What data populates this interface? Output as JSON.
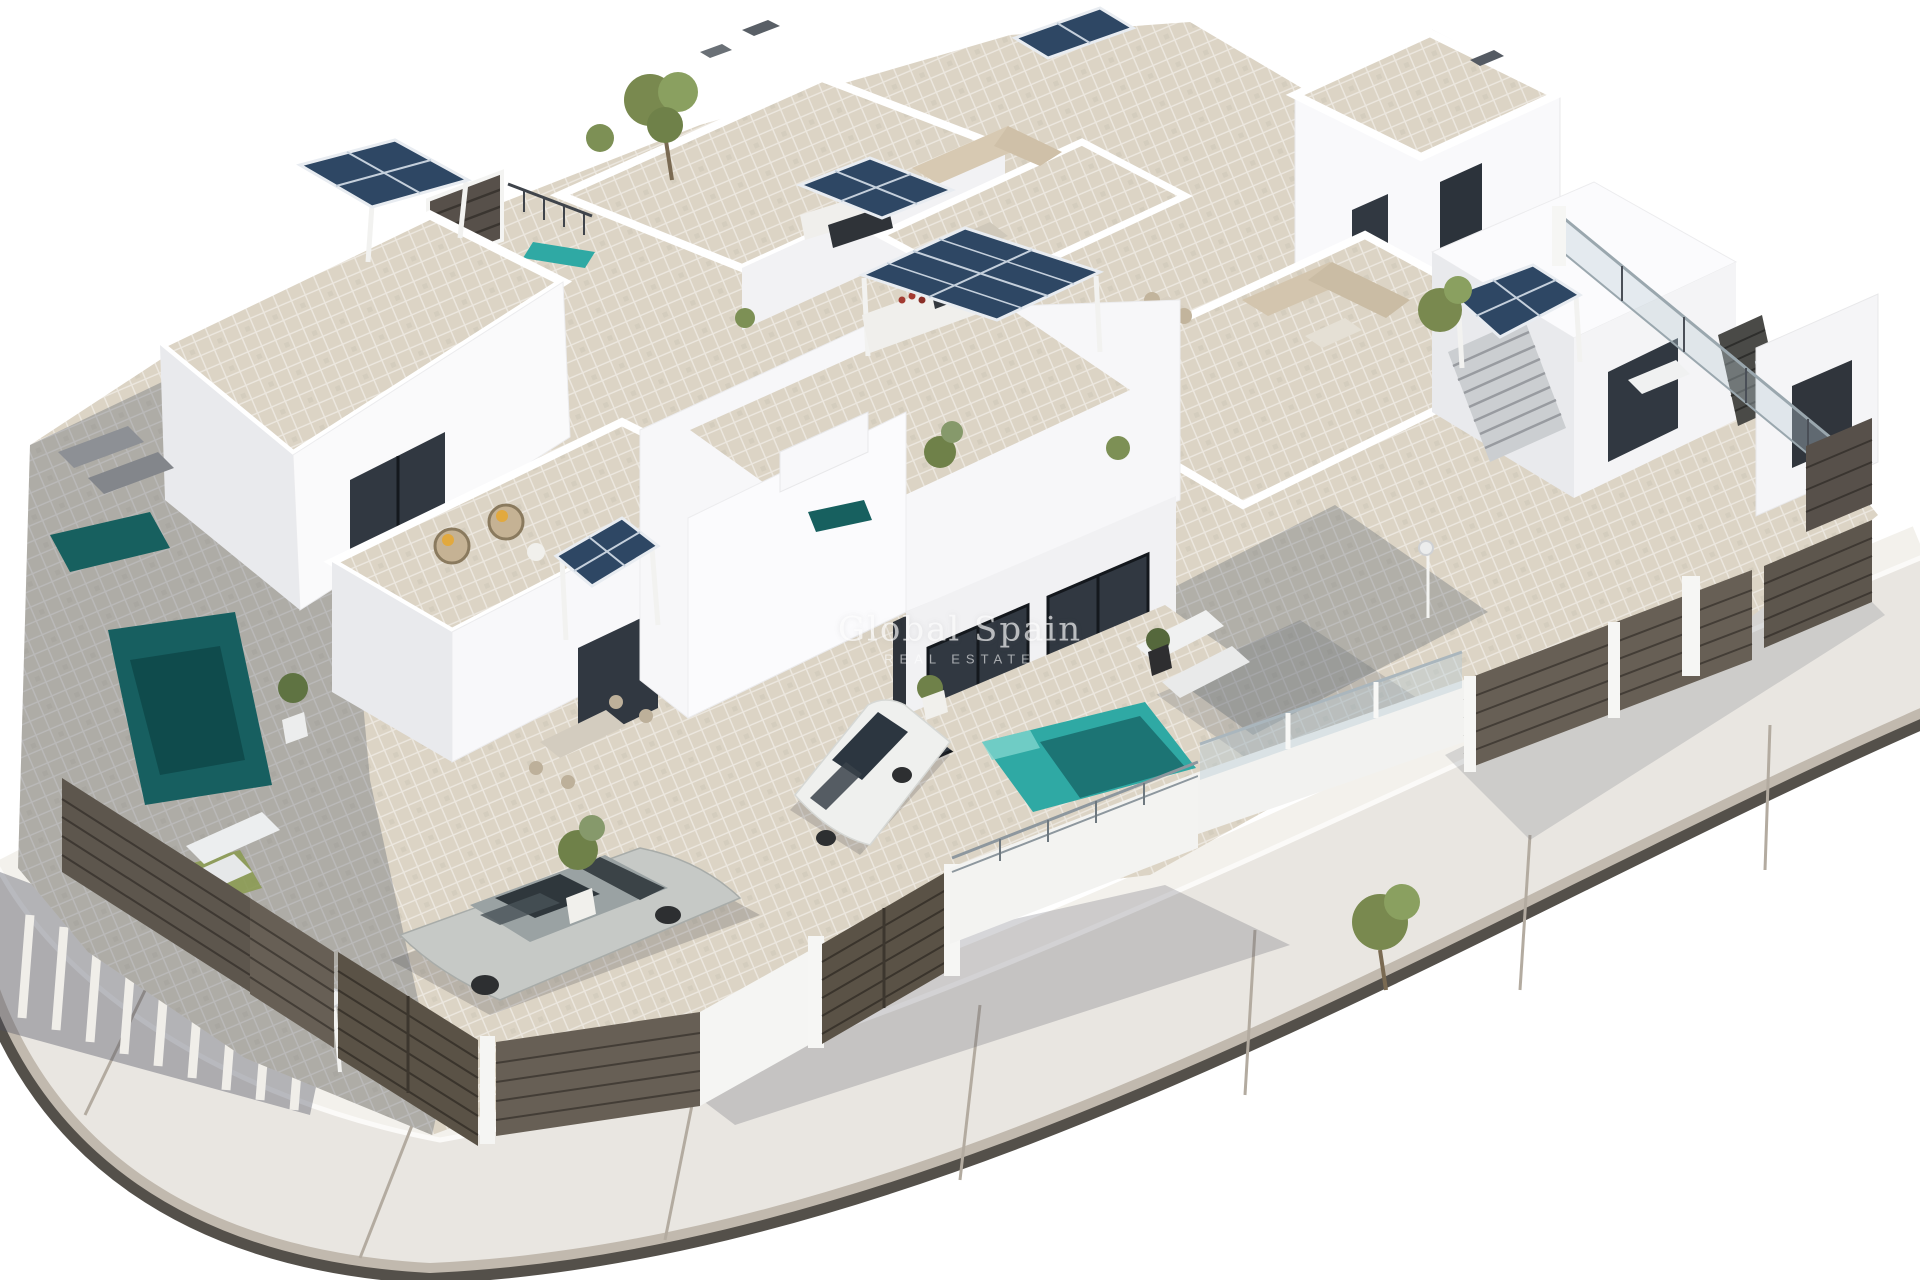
{
  "image": {
    "kind": "3D architectural aerial render",
    "subject": "Modern white residential villa development with rooftop terraces, solar panel pergolas, private swimming pools, parked cars, slatted privacy fences and a curved perimeter road"
  },
  "watermark": {
    "line1": "Global Spain",
    "line2": "REAL ESTATE"
  },
  "palette": {
    "background": "#ffffff",
    "road_surface": "#e9e6e1",
    "road_joint": "#b3aba0",
    "curb_dark": "#54504a",
    "curb_bevel": "#c1b9ae",
    "sidewalk": "#f3f1ec",
    "wall_bright": "#fbfbfd",
    "wall_mid": "#f1f1f3",
    "wall_shade": "#e2e3e6",
    "terrace_tile": "#dcd4c5",
    "terrace_tile_shaded": "#a7a6a8",
    "window_glass": "#313841",
    "solar_panel": "#2e4764",
    "pool_sunlit": "#2fa9a4",
    "pool_shaded": "#17605f",
    "fence_wood": "#675f55",
    "gate_wood": "#5a5246",
    "glass_railing": "#b9cdd6",
    "foliage": "#6f8149",
    "car_silver": "#c6c9c6",
    "car_white": "#eff0ee",
    "shadow": "rgba(70,78,95,0.32)"
  },
  "visible_objects": {
    "solar_panel_arrays": 7,
    "swimming_pools": 5,
    "parked_cars": 2,
    "sun_loungers": 8,
    "outdoor_dining_sets": 4,
    "sofa_lounges": 3,
    "staircases": 2,
    "driveway_gates": 2
  }
}
